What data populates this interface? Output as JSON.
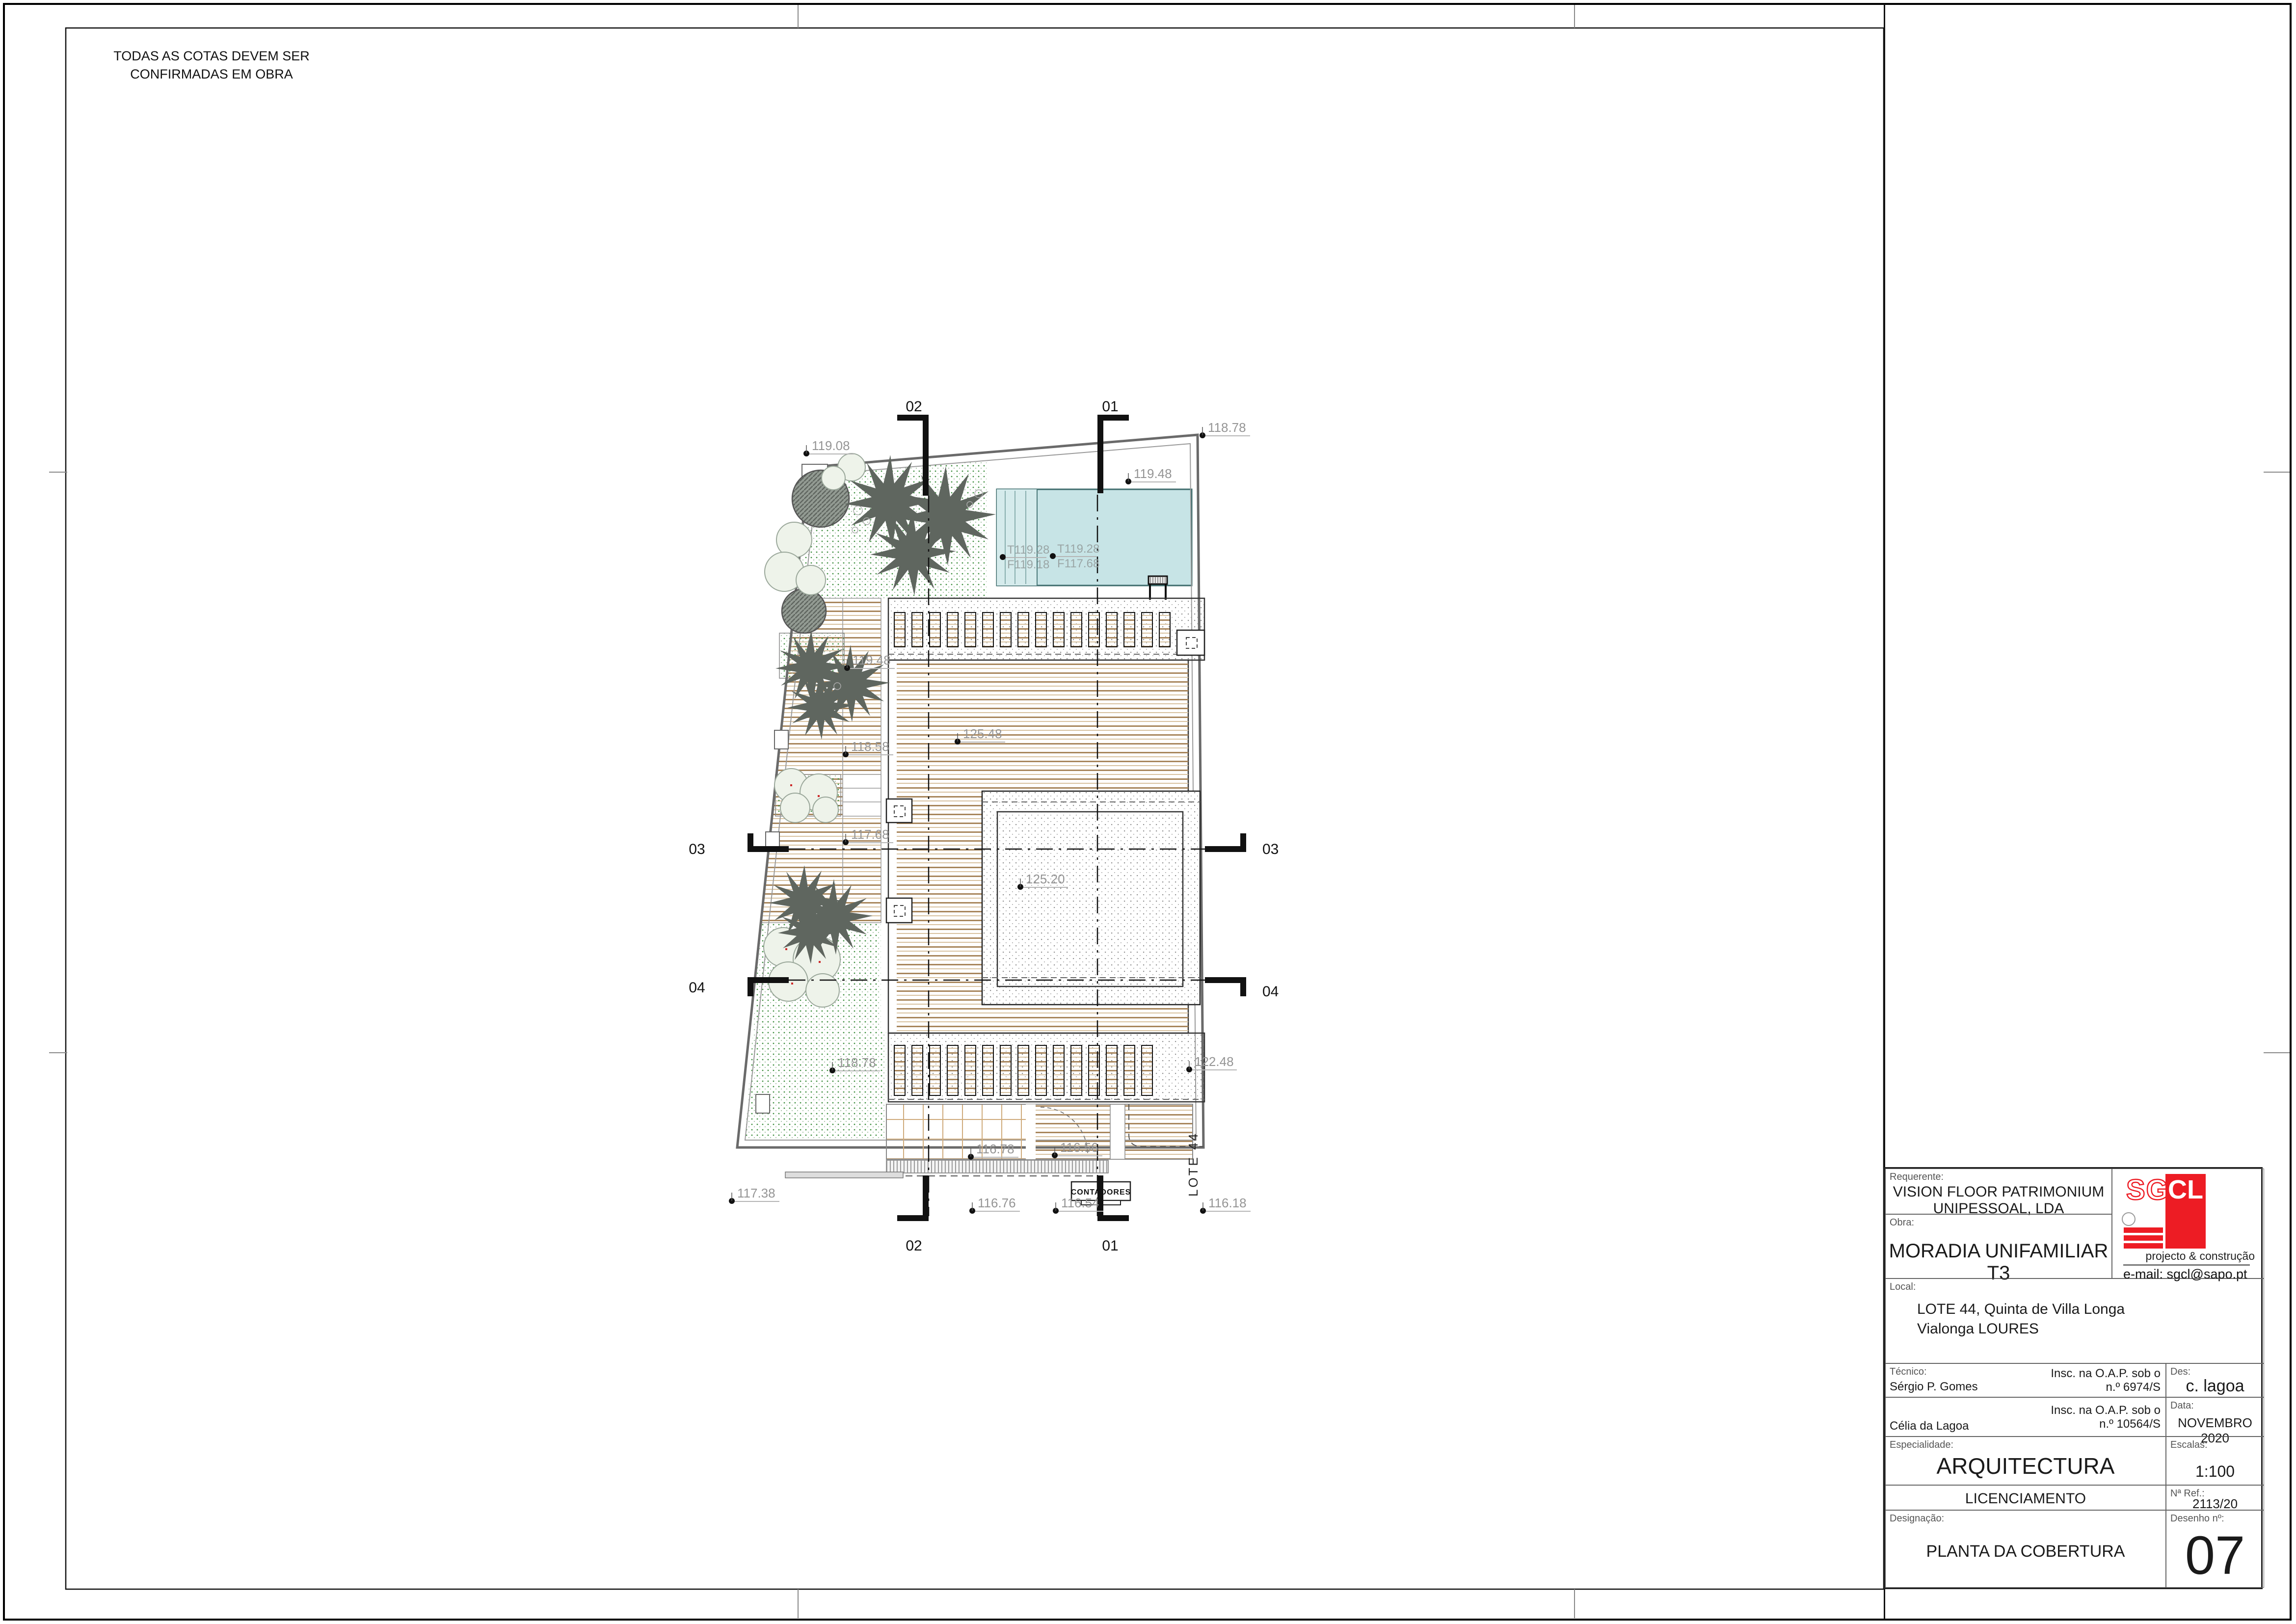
{
  "note": {
    "line1": "TODAS AS COTAS DEVEM SER",
    "line2": "CONFIRMADAS EM OBRA"
  },
  "drawing": {
    "lot_label": "LOTE 44",
    "contadores_label": "CONTADORES",
    "sections": {
      "s01": "01",
      "s02": "02",
      "s03": "03",
      "s04": "04"
    },
    "levels": [
      "119.08",
      "118.78",
      "119.48",
      "119.48",
      "118.58",
      "117.68",
      "125.48",
      "125.20",
      "122.48",
      "118.78",
      "116.78",
      "116.56",
      "117.38",
      "116.76",
      "116.54",
      "116.18"
    ],
    "pool_levels": [
      {
        "t": "T119.28",
        "f": "F119.18"
      },
      {
        "t": "T119.28",
        "f": "F117.68"
      }
    ]
  },
  "title_block": {
    "requerente_label": "Requerente:",
    "requerente_value_line1": "VISION FLOOR PATRIMONIUM",
    "requerente_value_line2": "UNIPESSOAL, LDA",
    "obra_label": "Obra:",
    "obra_value": "MORADIA UNIFAMILIAR T3",
    "local_label": "Local:",
    "local_value_line1": "LOTE 44, Quinta de Villa Longa",
    "local_value_line2": "Vialonga LOURES",
    "tecnico_label": "Técnico:",
    "tecnico1_name": "Sérgio P. Gomes",
    "tecnico1_insc_line1": "Insc. na O.A.P. sob o",
    "tecnico1_insc_line2": "n.º 6974/S",
    "tecnico2_name": "Célia da Lagoa",
    "tecnico2_insc_line1": "Insc. na O.A.P. sob o",
    "tecnico2_insc_line2": "n.º 10564/S",
    "des_label": "Des:",
    "des_value": "c. lagoa",
    "data_label": "Data:",
    "data_value": "NOVEMBRO 2020",
    "especialidade_label": "Especialidade:",
    "especialidade_value": "ARQUITECTURA",
    "escalas_label": "Escalas:",
    "escalas_value": "1:100",
    "fase_value": "LICENCIAMENTO",
    "ref_label": "Nª Ref.:",
    "ref_value": "2113/20",
    "designacao_label": "Designação:",
    "designacao_value": "PLANTA DA COBERTURA",
    "desenho_label": "Desenho nº:",
    "desenho_value": "07",
    "logo": {
      "sg": "SG",
      "cl": "CL",
      "tagline": "projecto & construção",
      "email": "e-mail: sgcl@sapo.pt",
      "red": "#ed1c24"
    }
  }
}
